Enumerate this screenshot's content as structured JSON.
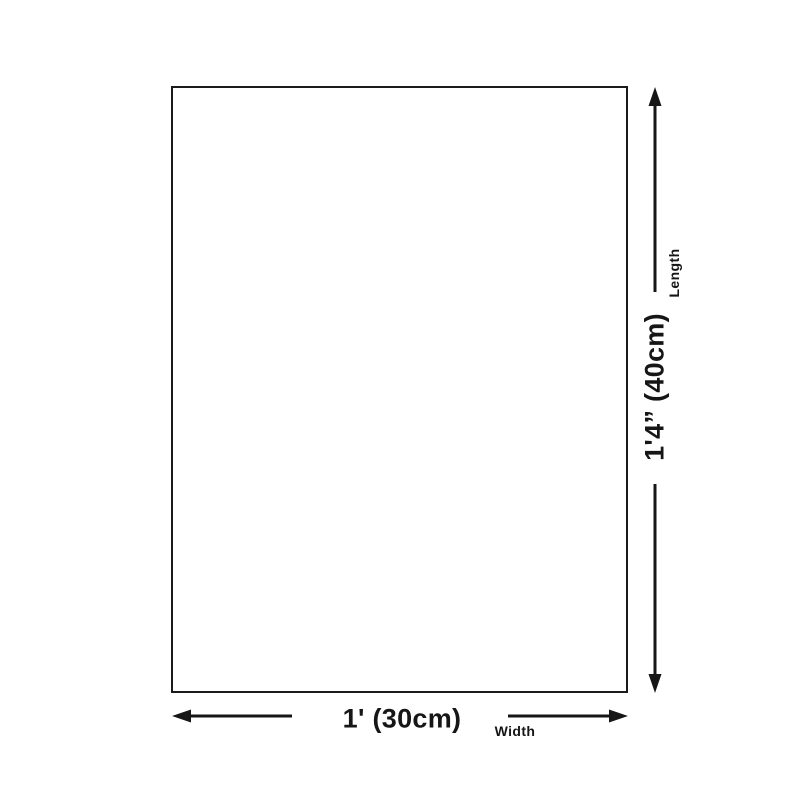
{
  "diagram": {
    "type": "product-dimension-diagram",
    "colors": {
      "background": "#ffffff",
      "ink": "#161616",
      "outline": "#1b1b1b"
    },
    "product": {
      "shape": "rectangle",
      "fill": "#ffffff"
    },
    "dimensions": {
      "length": {
        "value": "1'4” (40cm)",
        "label": "Length"
      },
      "width": {
        "value": "1' (30cm)",
        "label": "Width"
      }
    },
    "icons": {
      "up": "arrow-up-icon",
      "down": "arrow-down-icon",
      "left": "arrow-left-icon",
      "right": "arrow-right-icon"
    }
  }
}
